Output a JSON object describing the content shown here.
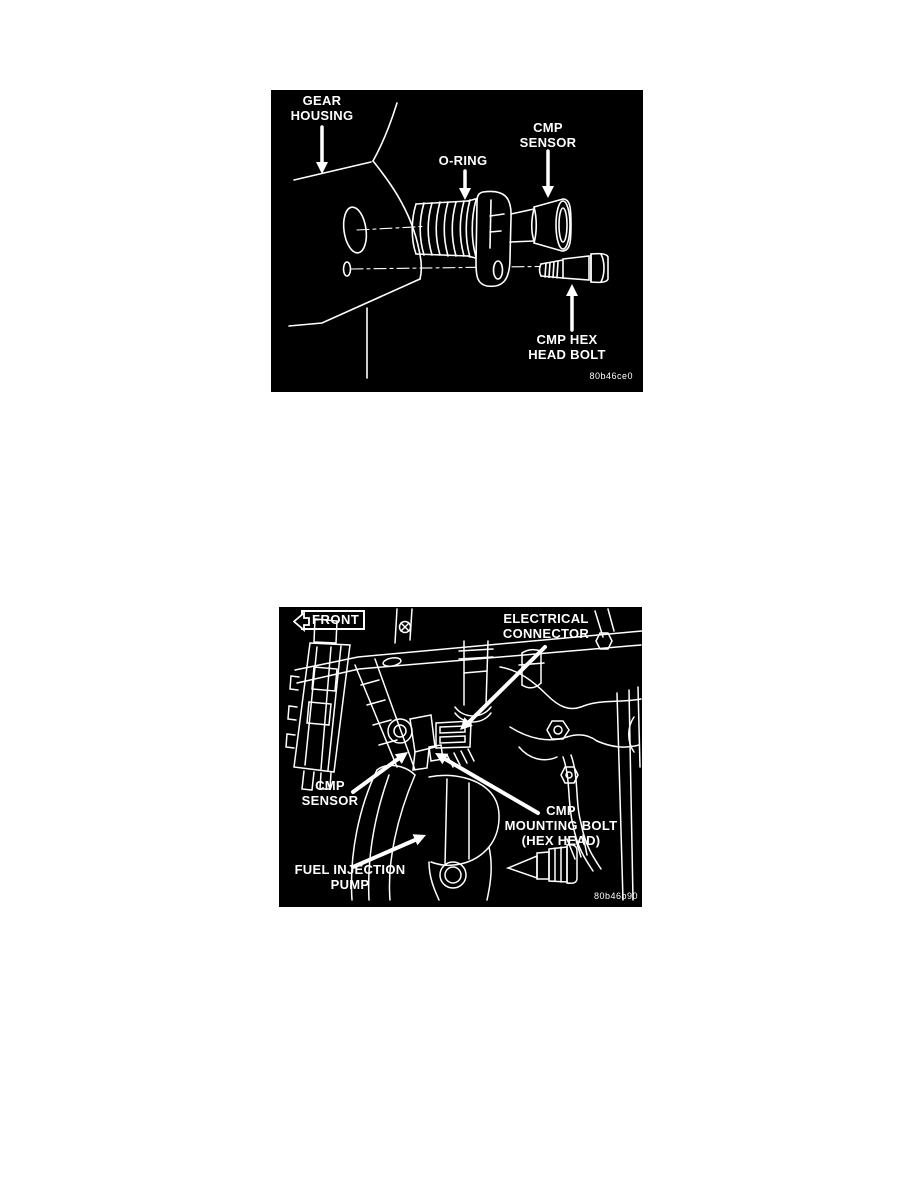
{
  "colors": {
    "page_background": "#ffffff",
    "diagram_background": "#000000",
    "line_color": "#ffffff"
  },
  "figure1": {
    "description": "CMP sensor exploded view at gear housing",
    "code": "80b46ce0",
    "labels": {
      "gear_housing": {
        "line1": "GEAR",
        "line2": "HOUSING"
      },
      "o_ring": {
        "line1": "O-RING"
      },
      "cmp_sensor": {
        "line1": "CMP",
        "line2": "SENSOR"
      },
      "cmp_hex_head_bolt": {
        "line1": "CMP HEX",
        "line2": "HEAD BOLT"
      }
    }
  },
  "figure2": {
    "description": "CMP sensor installed location at fuel injection pump",
    "code": "80b46b90",
    "labels": {
      "front": "FRONT",
      "electrical_connector": {
        "line1": "ELECTRICAL",
        "line2": "CONNECTOR"
      },
      "cmp_sensor": {
        "line1": "CMP",
        "line2": "SENSOR"
      },
      "cmp_mounting_bolt": {
        "line1": "CMP",
        "line2": "MOUNTING BOLT",
        "line3": "(HEX HEAD)"
      },
      "fuel_injection_pump": {
        "line1": "FUEL INJECTION",
        "line2": "PUMP"
      }
    }
  }
}
